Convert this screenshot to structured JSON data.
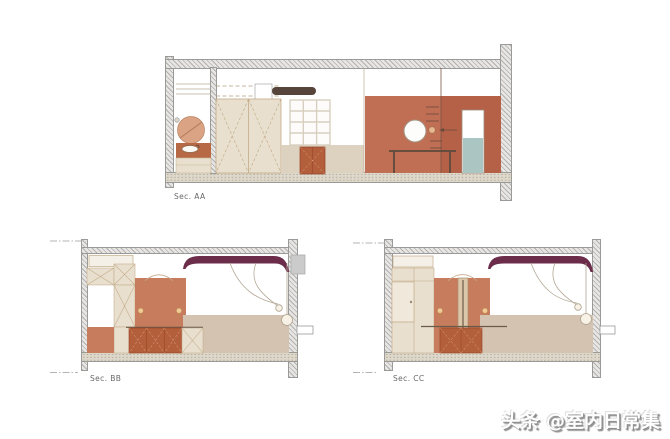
{
  "sections": [
    {
      "id": "sec-aa",
      "label": "Sec. AA"
    },
    {
      "id": "sec-bb",
      "label": "Sec. BB"
    },
    {
      "id": "sec-cc",
      "label": "Sec. CC"
    }
  ],
  "watermark": {
    "text": "头条 @室内日常集"
  },
  "colors": {
    "hatch-bg": "#e7e6e4",
    "hatch-line": "#b3b1ae",
    "floor-bg": "#ddd8cb",
    "floor-dot": "#b4ac97",
    "wall-edge": "#9a9a98",
    "terracotta-wall": "#c06f55",
    "terracotta-wall-dark": "#b56148",
    "terracotta-panel": "#c67c5d",
    "cabinet-orange": "#b35f3c",
    "counter-brown": "#b76844",
    "mirror-peach": "#d9a384",
    "beige": "#e9dfcf",
    "wainscot-aa": "#ddd2bf",
    "wainscot-bc": "#d5c3b1",
    "maroon": "#6b2d4a",
    "teal": "#abc6c2",
    "dark-bar": "#57443a",
    "line-tan": "#c2ab87",
    "line-dark": "#6b5a4a",
    "sconce": "#eeca96",
    "gray-box": "#cbcbcb",
    "pendant": "#f7f1e6",
    "wire": "#b3a897",
    "label": "#696969",
    "watermark-shadow": "#8e8e8e"
  }
}
